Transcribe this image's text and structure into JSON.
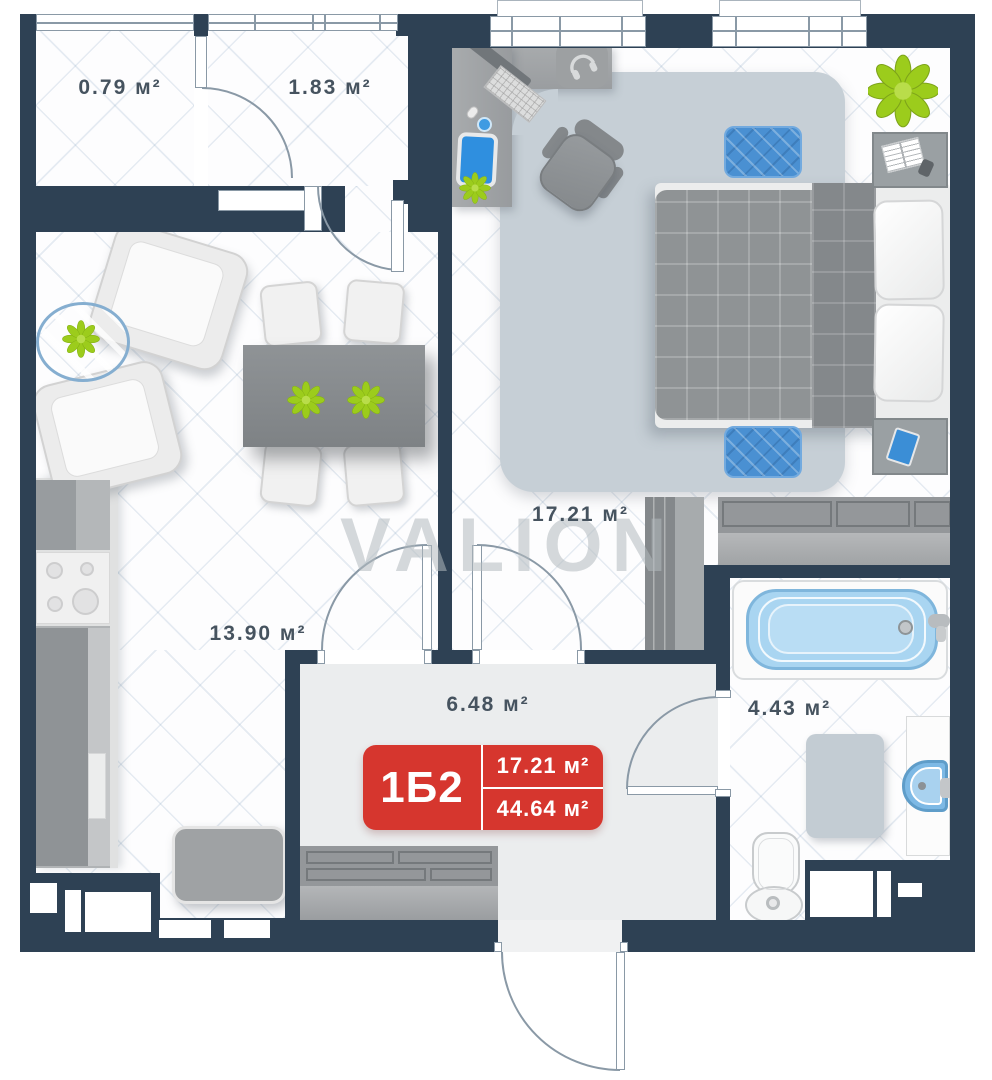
{
  "watermark": {
    "text": "VALION"
  },
  "badge": {
    "unit_code": "1Б2",
    "room_area": "17.21 м²",
    "total_area": "44.64 м²",
    "color": "#d6362e"
  },
  "rooms": [
    {
      "name": "balcony",
      "area_label": "0.79 м²"
    },
    {
      "name": "wardrobe-room",
      "area_label": "1.83 м²"
    },
    {
      "name": "bedroom",
      "area_label": "17.21 м²"
    },
    {
      "name": "kitchen-living-room",
      "area_label": "13.90 м²"
    },
    {
      "name": "hallway",
      "area_label": "6.48 м²"
    },
    {
      "name": "bathroom",
      "area_label": "4.43 м²"
    }
  ],
  "colors": {
    "wall": "#2e4154",
    "badge_red": "#d6362e",
    "accent_blue": "#4a90d2",
    "rug_gray_blue": "#c6cfd6",
    "hallway_floor": "#ebedee",
    "plant_green": "#9ccc1c",
    "label_text": "#46535f"
  }
}
